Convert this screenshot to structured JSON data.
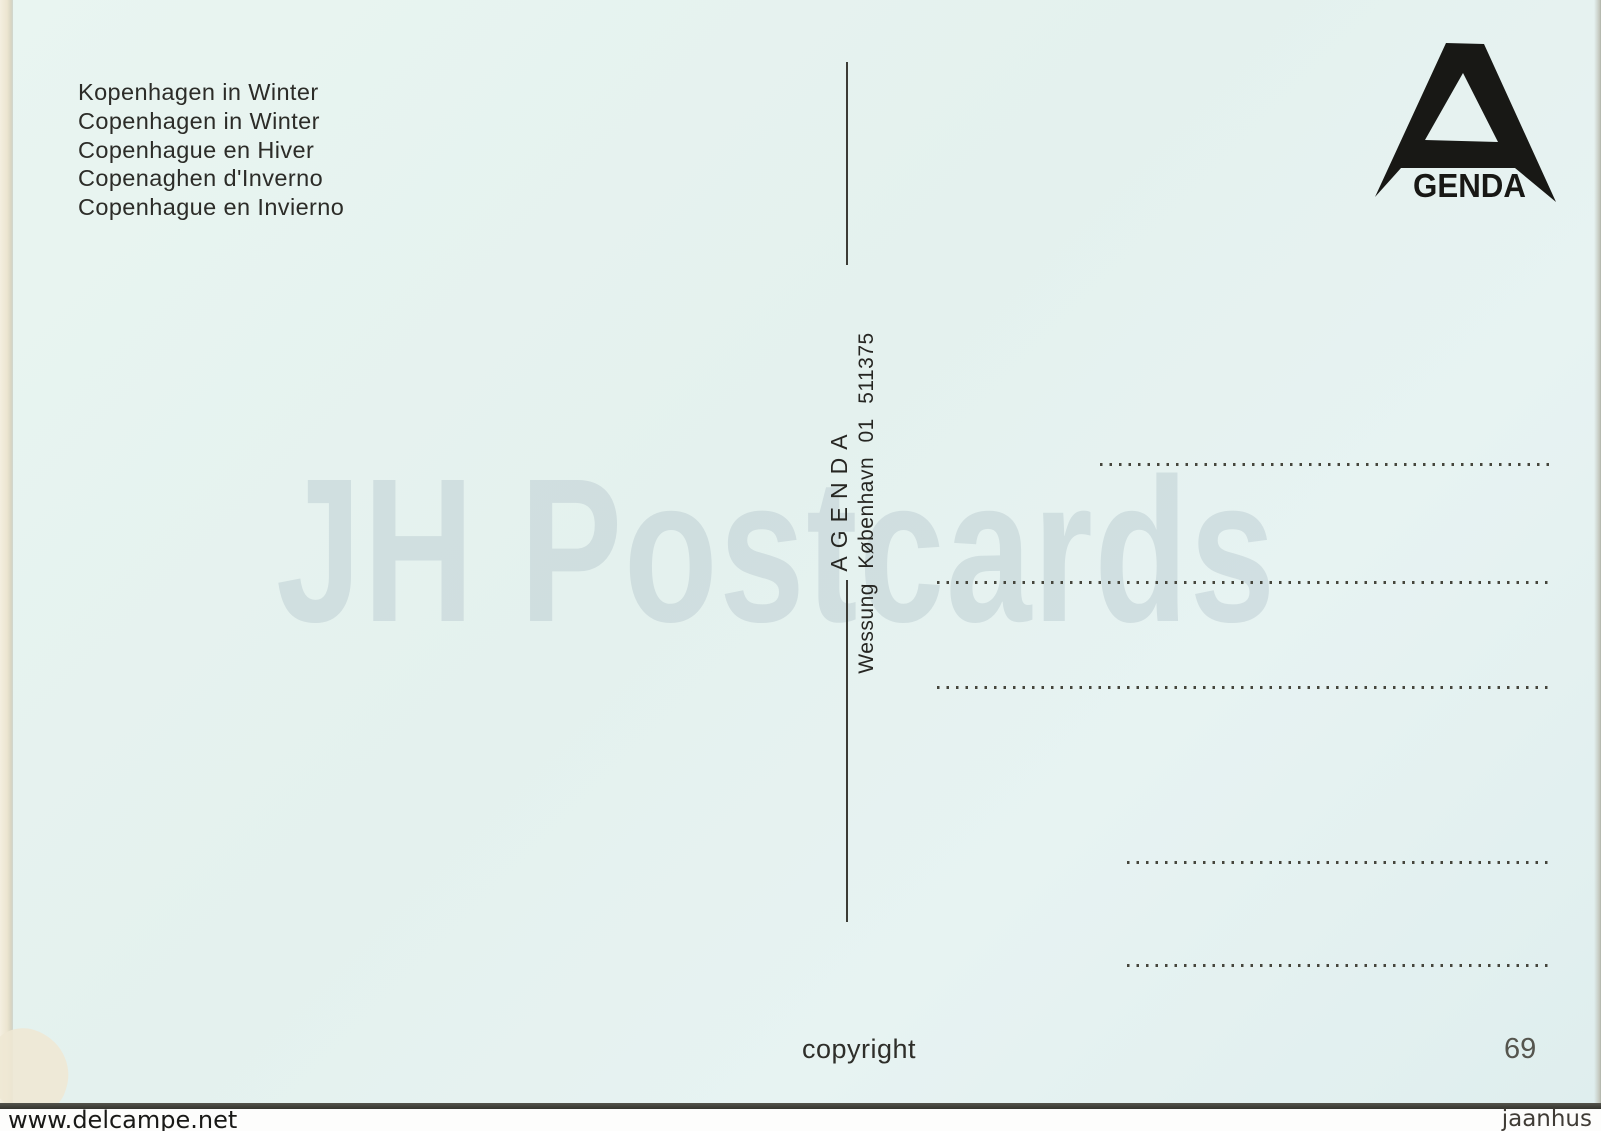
{
  "postcard": {
    "background_color": "#e6f2ef",
    "titles": [
      "Kopenhagen in Winter",
      "Copenhagen in Winter",
      "Copenhague en Hiver",
      "Copenaghen d'Inverno",
      "Copenhague en Invierno"
    ],
    "logo": {
      "letter": "A",
      "text": "GENDA",
      "color": "#181815"
    },
    "center_vertical": {
      "brand": "AGENDA",
      "publisher_line": "Wessung København 01 511375"
    },
    "footer": {
      "copyright_label": "copyright",
      "number": "69"
    }
  },
  "watermarks": {
    "main": "JH Postcards",
    "bottom_left": "www.delcampe.net",
    "bottom_right": "jaanhus"
  }
}
